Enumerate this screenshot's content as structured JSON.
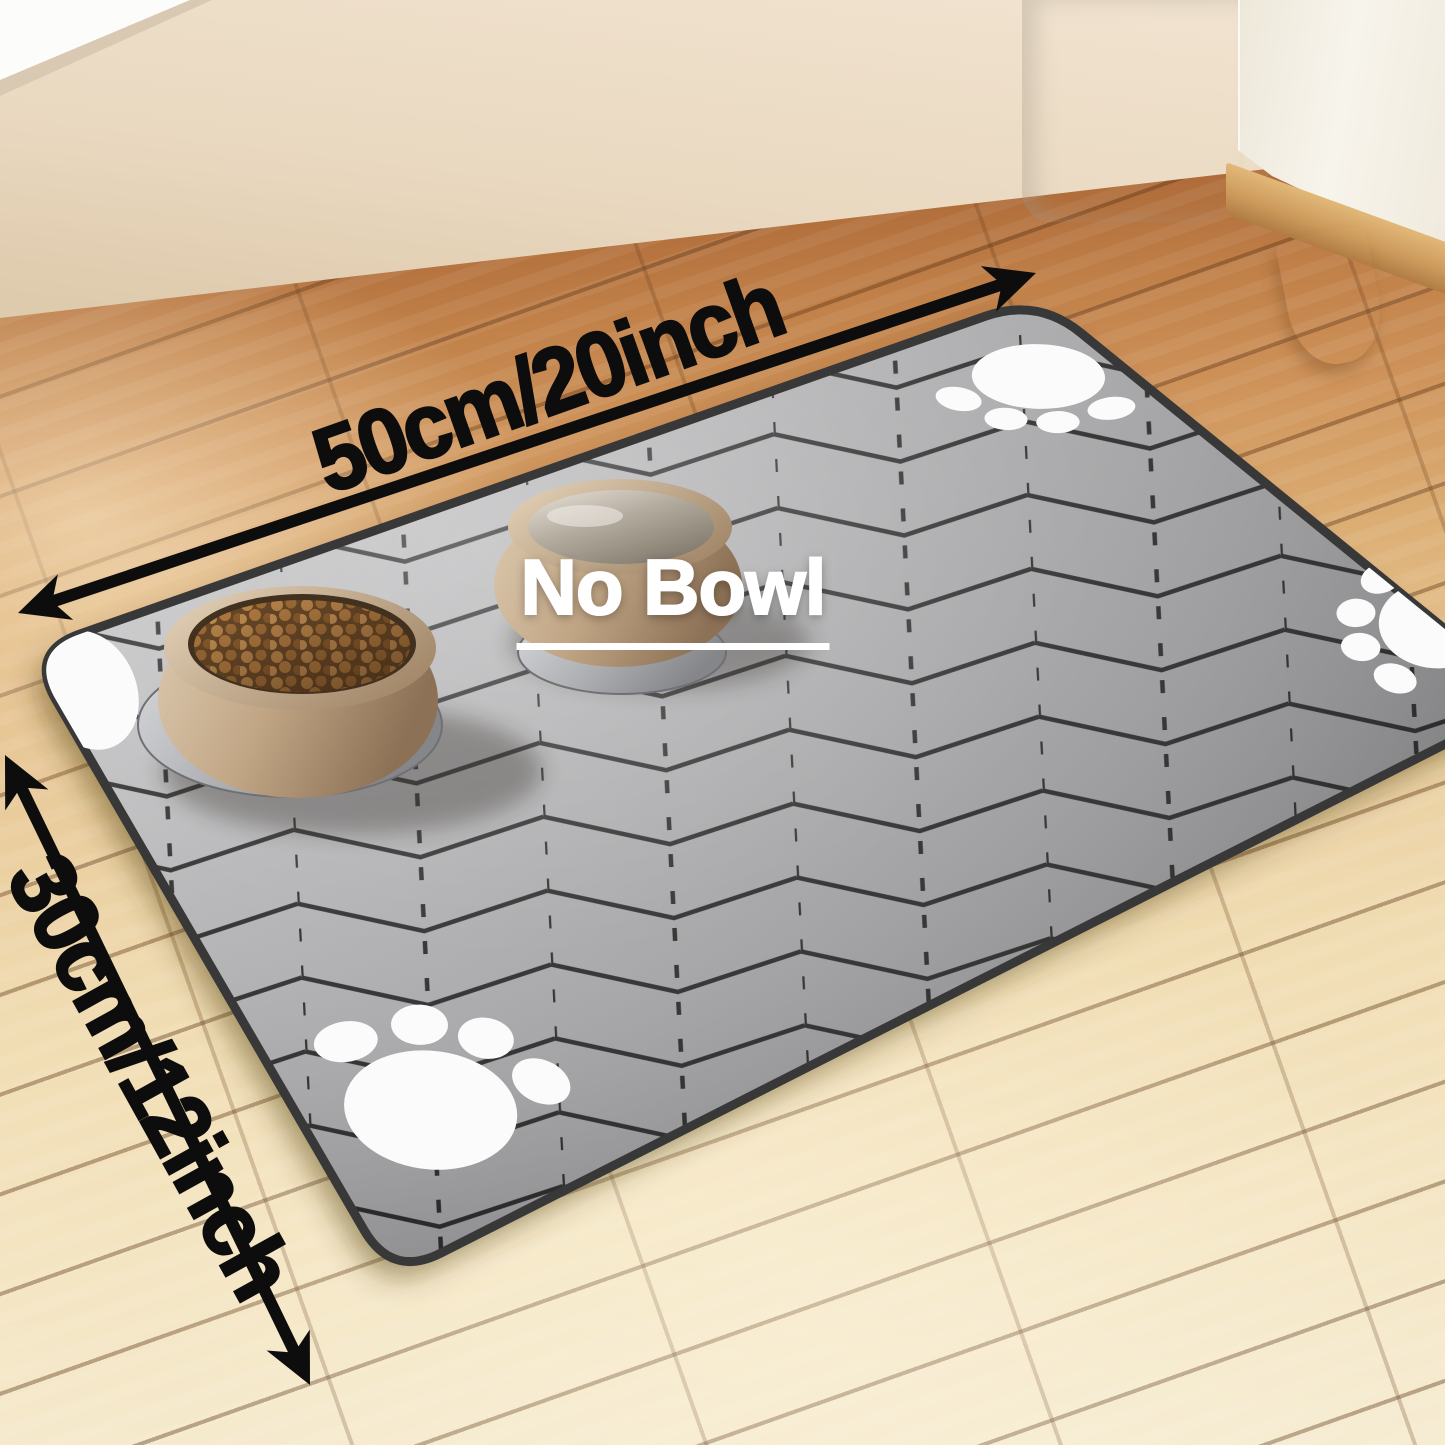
{
  "labels": {
    "length_label": "50cm/20inch",
    "width_label": "30cm/12inch",
    "no_bowl_label": "No Bowl"
  },
  "objects": {
    "mat": "gray herringbone absorbent pet feeding mat",
    "food_bowl": "tan pet bowl filled with kibble",
    "water_bowl": "tan pet bowl filled with water",
    "paw_print_count": 4,
    "background": "wood floor, beige wall, white curtains, cream cabinet with wooden leg"
  },
  "colors": {
    "arrow_black": "#0d0d0d",
    "label_white": "#ffffff",
    "mat_gray": "#a6a6a8",
    "mat_line_dark": "#2e2e2e",
    "mat_edge_dark": "#383838",
    "paw_white": "#fbfbfb",
    "bowl_tan": "#c3a887",
    "kibble_brown": "#a06c38",
    "floor_orange": "#c08048",
    "floor_pale": "#f3e2bd",
    "wall_beige": "#e9d8c0",
    "curtain_white": "#f7f5f1"
  }
}
